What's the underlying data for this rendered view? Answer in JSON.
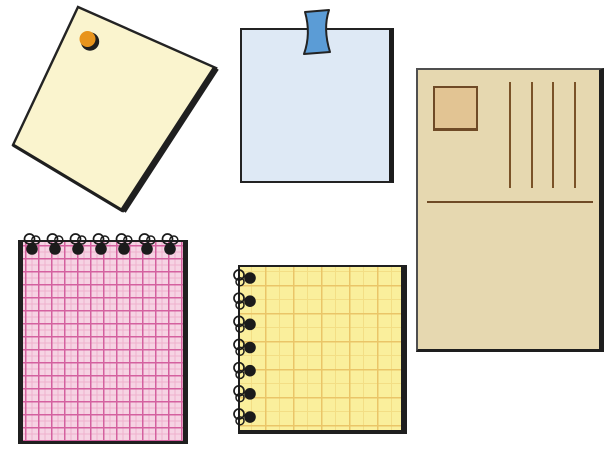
{
  "scene": {
    "type": "stationery-clipart-illustration",
    "background_color": "#FFFFFF",
    "ink_color": "#232323"
  },
  "items": {
    "pinned_note": {
      "name": "cream square note fixed with an orange pushpin, tilted",
      "paper_color": "#FAF4CE",
      "pin_color": "#E8941C"
    },
    "taped_note": {
      "name": "light blue square note fixed with blue tape at top center",
      "paper_color": "#DEE9F5",
      "tape_color": "#5B9CD6"
    },
    "postcard": {
      "name": "tan portrait postcard with stamp box, address lines and divider",
      "paper_color": "#E6D8B0",
      "stamp_fill": "#E2C493",
      "stamp_border": "#6F4A26",
      "line_color": "#7A5228",
      "address_line_count": 4,
      "address_line_spacing_px": 21.5
    },
    "notebook_top_spiral": {
      "name": "pink checked notebook with spiral binding along the top edge",
      "paper_color": "#F6D3E3",
      "grid_major_color": "#D4619F",
      "grid_minor_color": "#EFB0CD",
      "ring_count": 7,
      "ring_color": "#1B1B1B"
    },
    "notepad_left_spiral": {
      "name": "yellow checked notepad with spiral binding along the left edge",
      "paper_color": "#FAEF9C",
      "grid_major_color": "#EAC568",
      "grid_minor_color": "#F3DE85",
      "ring_count": 7,
      "ring_color": "#1B1B1B"
    }
  }
}
